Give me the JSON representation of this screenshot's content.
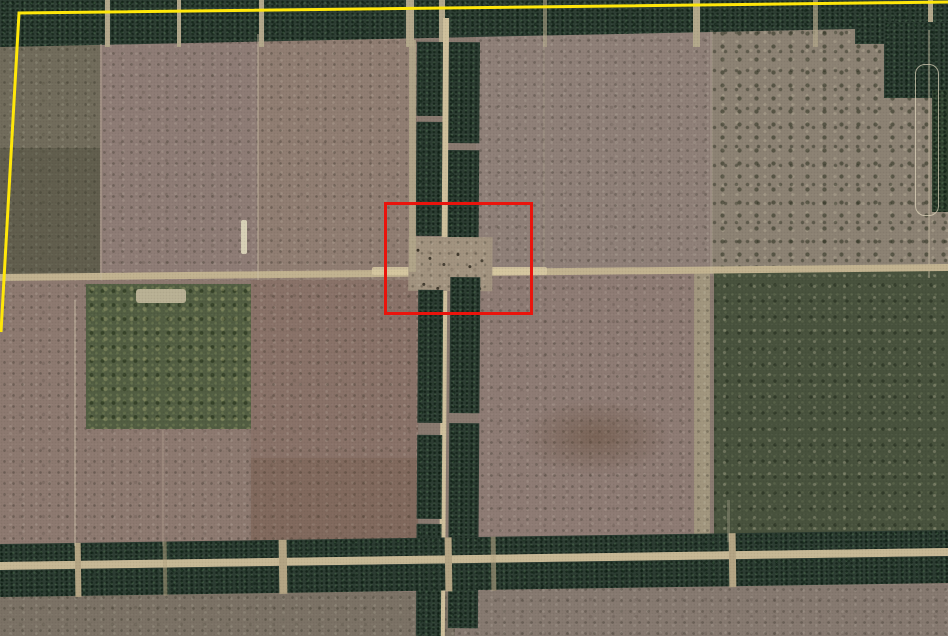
{
  "canvas": {
    "width_px": 948,
    "height_px": 636,
    "kind": "satellite-aerial-imagery",
    "description": "Aerial/satellite view of cleared agricultural paddocks divided by dark-green tree windbreak shelterbelts and pale dirt tracks, with a yellow property-boundary overlay and a red highlight rectangle over the central shelterbelt road intersection."
  },
  "annotations": {
    "red_box": {
      "name": "highlight-rectangle",
      "color": "#ea140c",
      "x": 384,
      "y": 202,
      "width": 149,
      "height": 113,
      "border_px": 3
    },
    "yellow_boundary": {
      "name": "property-boundary-line",
      "color": "#ffe70a",
      "stroke_px": 3,
      "points": "948,2 19,13 1,332"
    }
  },
  "scene": {
    "features": [
      {
        "name": "tree-windbreak-top",
        "color": "#2d3e33",
        "type": "shelterbelt band across top"
      },
      {
        "name": "tree-windbreak-center-vertical",
        "color": "#2c3d32",
        "type": "double shelterbelt with central dirt road"
      },
      {
        "name": "tree-windbreak-bottom",
        "color": "#2c3d32",
        "type": "double shelterbelt with dirt road, full width"
      },
      {
        "name": "horizontal-dirt-road",
        "color": "#c2b390",
        "type": "east-west track at mid height"
      },
      {
        "name": "intersection-clearing",
        "color": "#a2937f",
        "type": "cleared dirt area inside red box"
      },
      {
        "name": "field-top-left",
        "color": "#716c5b"
      },
      {
        "name": "field-top-center",
        "color": "#8e7c75"
      },
      {
        "name": "field-top-center-2",
        "color": "#907d72"
      },
      {
        "name": "field-mid-top",
        "color": "#8f8078"
      },
      {
        "name": "field-top-right-scrub",
        "color": "#8c8273"
      },
      {
        "name": "field-left-mid",
        "color": "#8d7970"
      },
      {
        "name": "dark-vegetation-patch-left",
        "color": "#525e42"
      },
      {
        "name": "field-bottom-left-mid",
        "color": "#897268"
      },
      {
        "name": "field-bottom-mid",
        "color": "#8e7b74"
      },
      {
        "name": "field-bottom-right-dark",
        "color": "#48523d"
      },
      {
        "name": "field-bottom-strip-left",
        "color": "#7b7265"
      },
      {
        "name": "field-bottom-strip-right",
        "color": "#867970"
      },
      {
        "name": "cleared-loop-track-right-edge",
        "color": "#e4dac0"
      }
    ]
  }
}
